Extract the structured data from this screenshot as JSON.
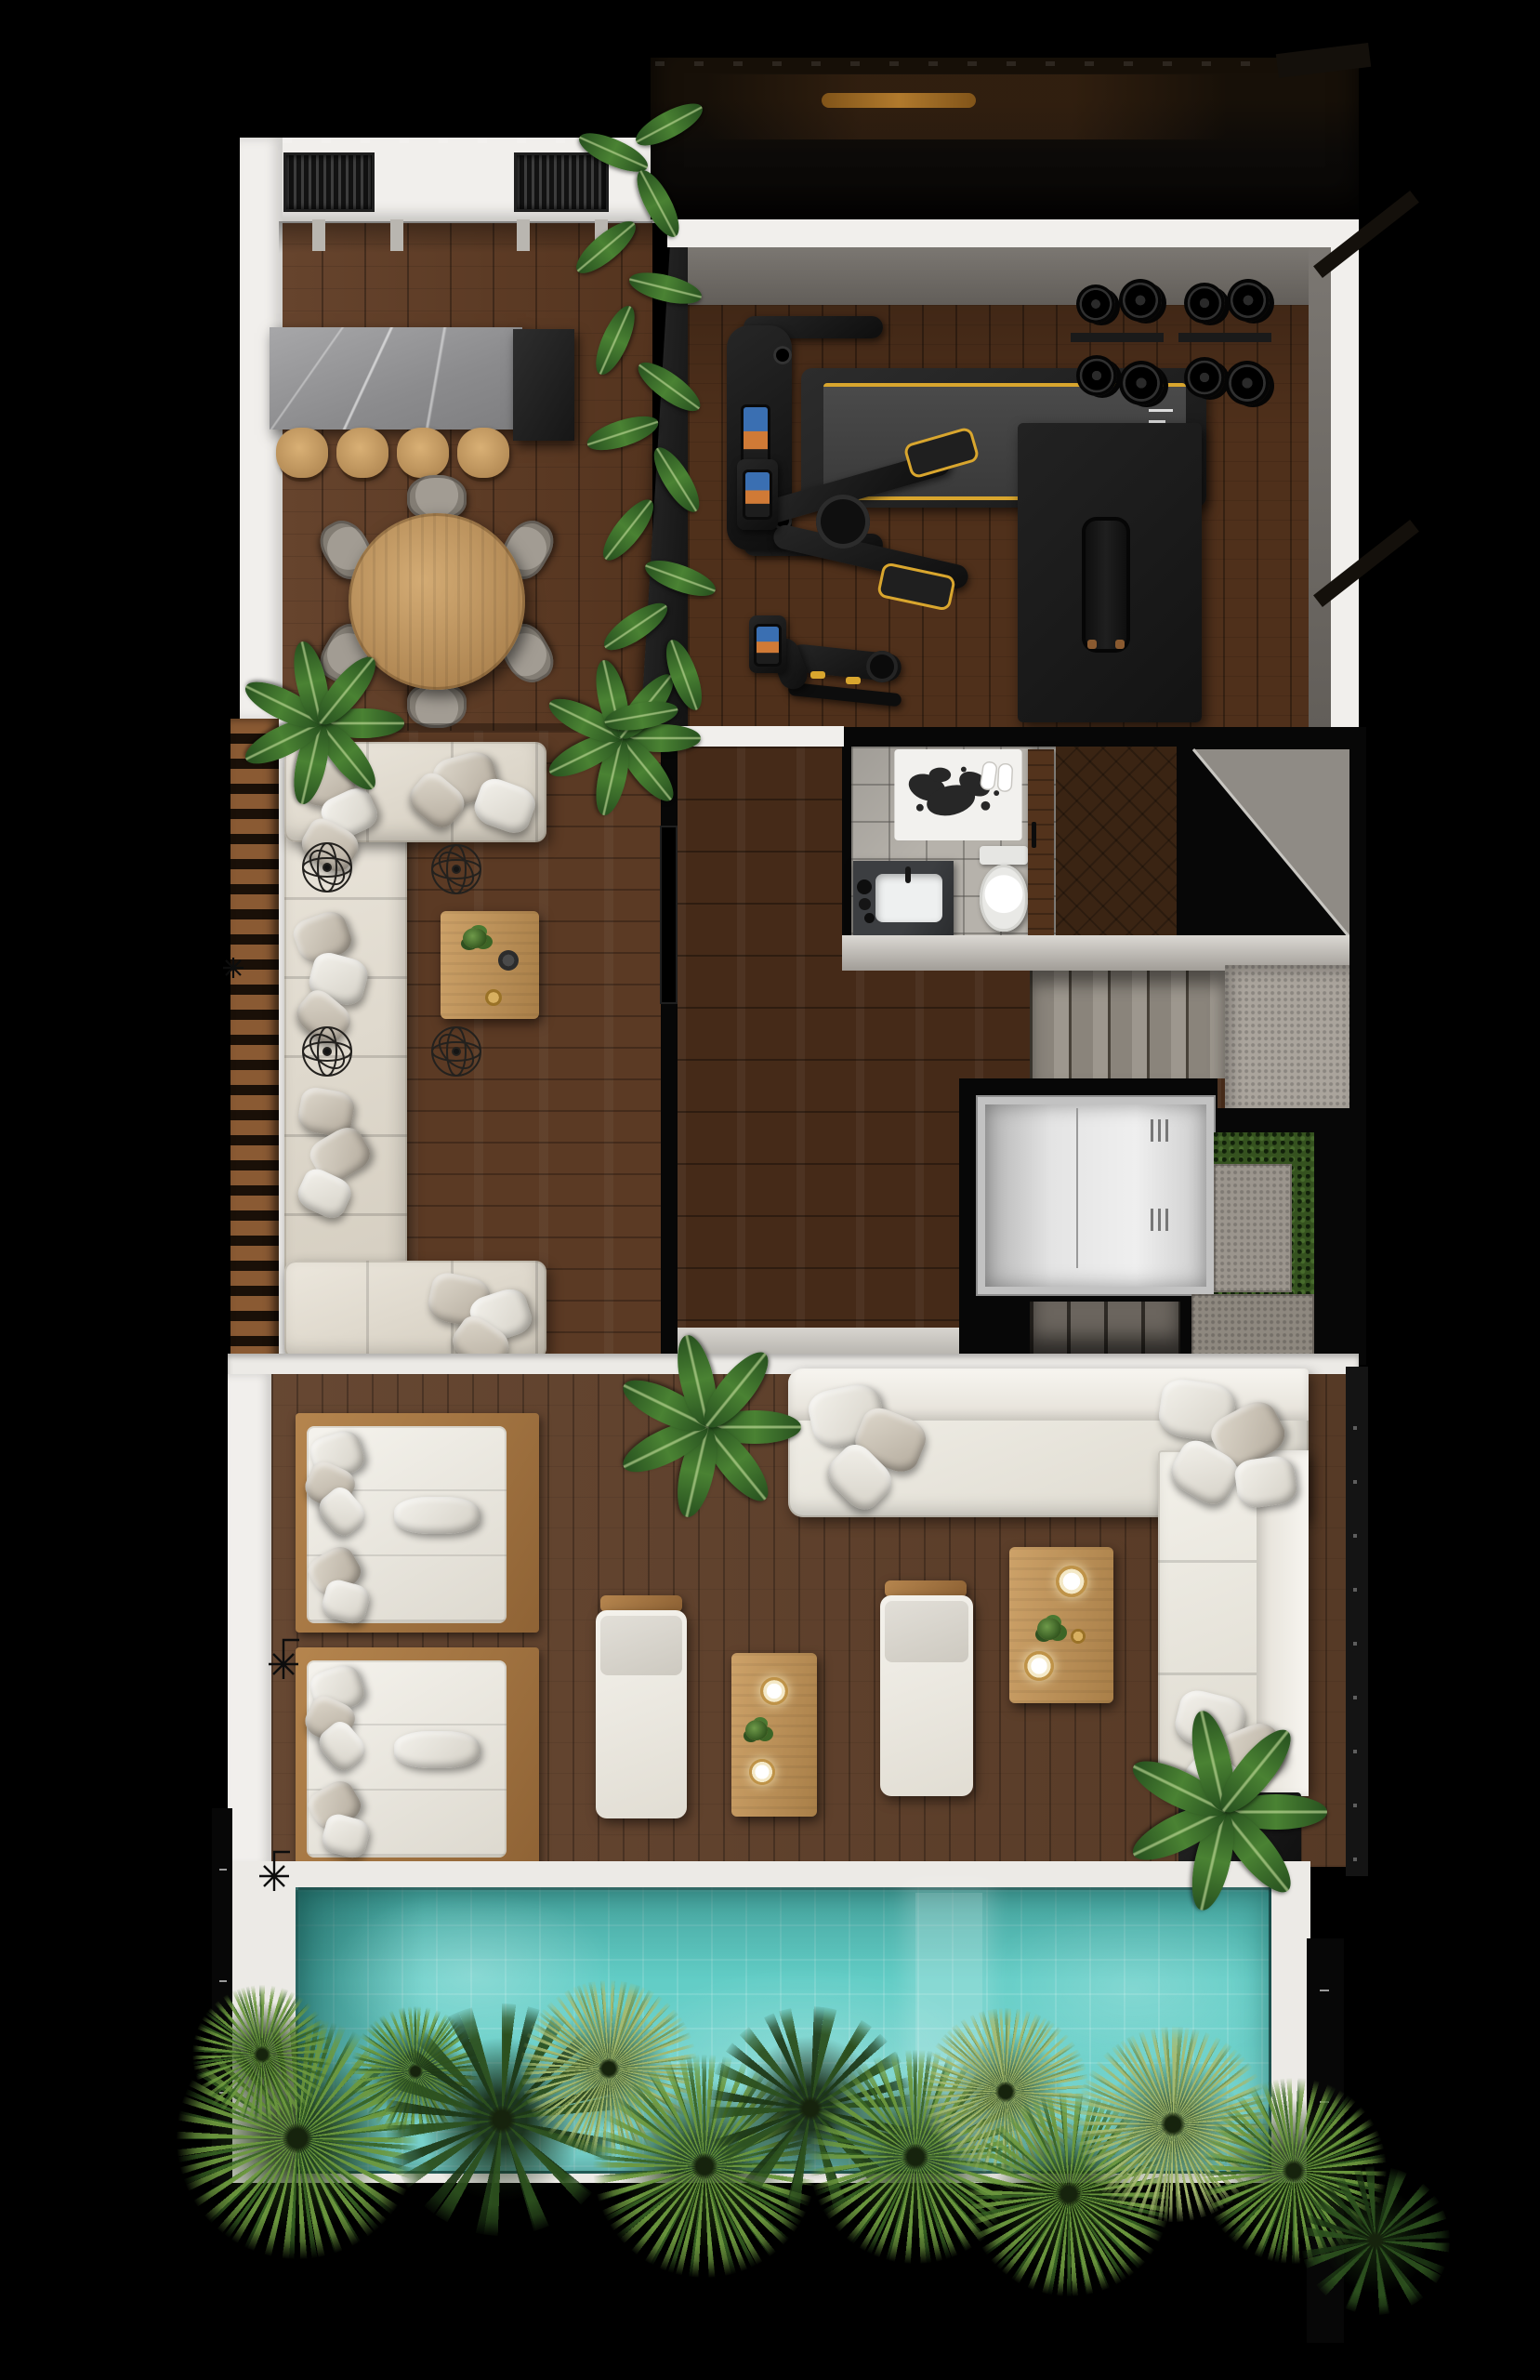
{
  "title": "Top-down 3D floor plan render of a rooftop penthouse level with outdoor kitchen, gym, louvered sofa terrace, bathroom, elevator and stair core, pool lounge deck, swimming pool and palm garden",
  "palette": {
    "bg": "#000000",
    "deck_white": "#eceae6",
    "wall_white": "#f1efec",
    "wall_shadow": "#cfccc6",
    "wood_dining": "#5e3a22",
    "wood_gym": "#4f301b",
    "wood_hall": "#452a18",
    "wood_terrace": "#5b3a24",
    "wood_lounge": "#60402a",
    "louver_wood": "#8a5a33",
    "louver_gap": "#1a1008",
    "marble_gray": "#98989a",
    "marble_dark": "#262626",
    "stool_wood": "#c79e66",
    "table_wood": "#c09659",
    "chair_gray": "#96918a",
    "sofa_cream": "#e7e2d9",
    "pillow_gray": "#bdb5a9",
    "lounge_white": "#f0eee9",
    "glass_dark": "#0c0a08",
    "amber": "#bf8430",
    "mat_gray": "#6f6b66",
    "equip_black": "#1d1d1d",
    "equip_yellow": "#d9a62e",
    "tile_bath": "#b6b2ab",
    "stair_gray": "#948e87",
    "landing_gray": "#aaa49c",
    "stair_dark": "#5b544d",
    "elevator_silver": "#d6d6d6",
    "hedge_green": "#35521f",
    "pool_teal": "#62cdc6",
    "fence_dark": "#141414",
    "planter_dark": "#181818"
  },
  "zones": [
    {
      "id": "outdoor-kitchen",
      "label": "Outdoor kitchen and dining",
      "furniture": [
        "wall counter with two slatted grill inserts",
        "gray marble bar island with dark end cabinet",
        "4 wooden bar stools",
        "round wooden dining table",
        "6 gray dining chairs",
        "potted plant"
      ]
    },
    {
      "id": "gym",
      "label": "Gym",
      "furniture": [
        "tinted glass wall with reflections and amber light stripe",
        "treadmill with console and yellow-striped belt",
        "2 weight plate racks with black plates",
        "elliptical cross trainer",
        "spin bike",
        "black exercise mat",
        "workout bench",
        "banana plant divider in dark planter"
      ]
    },
    {
      "id": "terrace-sofa",
      "label": "Louvered terrace lounge",
      "furniture": [
        "C-shaped cream sectional sofa with gray pillows",
        "wood coffee table with plant, bowl and gold dish",
        "4 wire decor spheres",
        "horizontal wood louver screen",
        "2 potted plants",
        "wall TV panel"
      ]
    },
    {
      "id": "bathroom",
      "label": "Bathroom",
      "furniture": [
        "black-and-white art mat with white slippers",
        "toilet",
        "dark marble vanity with white sink and faucet",
        "black jars",
        "wood door"
      ]
    },
    {
      "id": "stair-core",
      "label": "Stair and elevator core",
      "furniture": [
        "upper stair flight of 5 treads",
        "concrete landing",
        "under-stair gray void wedge",
        "silver elevator cabin in black shaft frame",
        "lower stair flight of 4 treads",
        "green hedge strip",
        "2 stone slabs"
      ]
    },
    {
      "id": "lounge",
      "label": "Pool lounge deck",
      "furniture": [
        "2 wood-framed daybeds with white mattresses and pillows",
        "L-shaped white sectional sofa with pillows",
        "2 white sun loungers with wood handles",
        "2 wood coffee tables with candle plates and sprigs",
        "2 potted banana plants",
        "outdoor shower plan symbol",
        "riveted dark fence"
      ]
    },
    {
      "id": "pool",
      "label": "Swimming pool",
      "furniture": [
        "turquoise tiled water with light mottling",
        "white coping deck",
        "light tanning band",
        "dark rim",
        "outdoor shower plan symbol",
        "black edge frames with tick marks"
      ]
    },
    {
      "id": "garden",
      "label": "Bottom garden strip",
      "furniture": [
        "fan palms",
        "feather palms",
        "pale spiky palms"
      ]
    }
  ],
  "counts": {
    "bar_stools": 4,
    "dining_chairs": 6,
    "grill_inserts": 2,
    "weight_plate_stacks": 8,
    "daybeds": 2,
    "sun_loungers": 2,
    "coffee_tables": 3,
    "candle_plates": 4,
    "wire_spheres": 4,
    "palm_clusters": 13,
    "stair_treads_upper": 5,
    "stair_treads_lower": 4,
    "elevator_vents": 2,
    "shower_symbols": 2
  }
}
